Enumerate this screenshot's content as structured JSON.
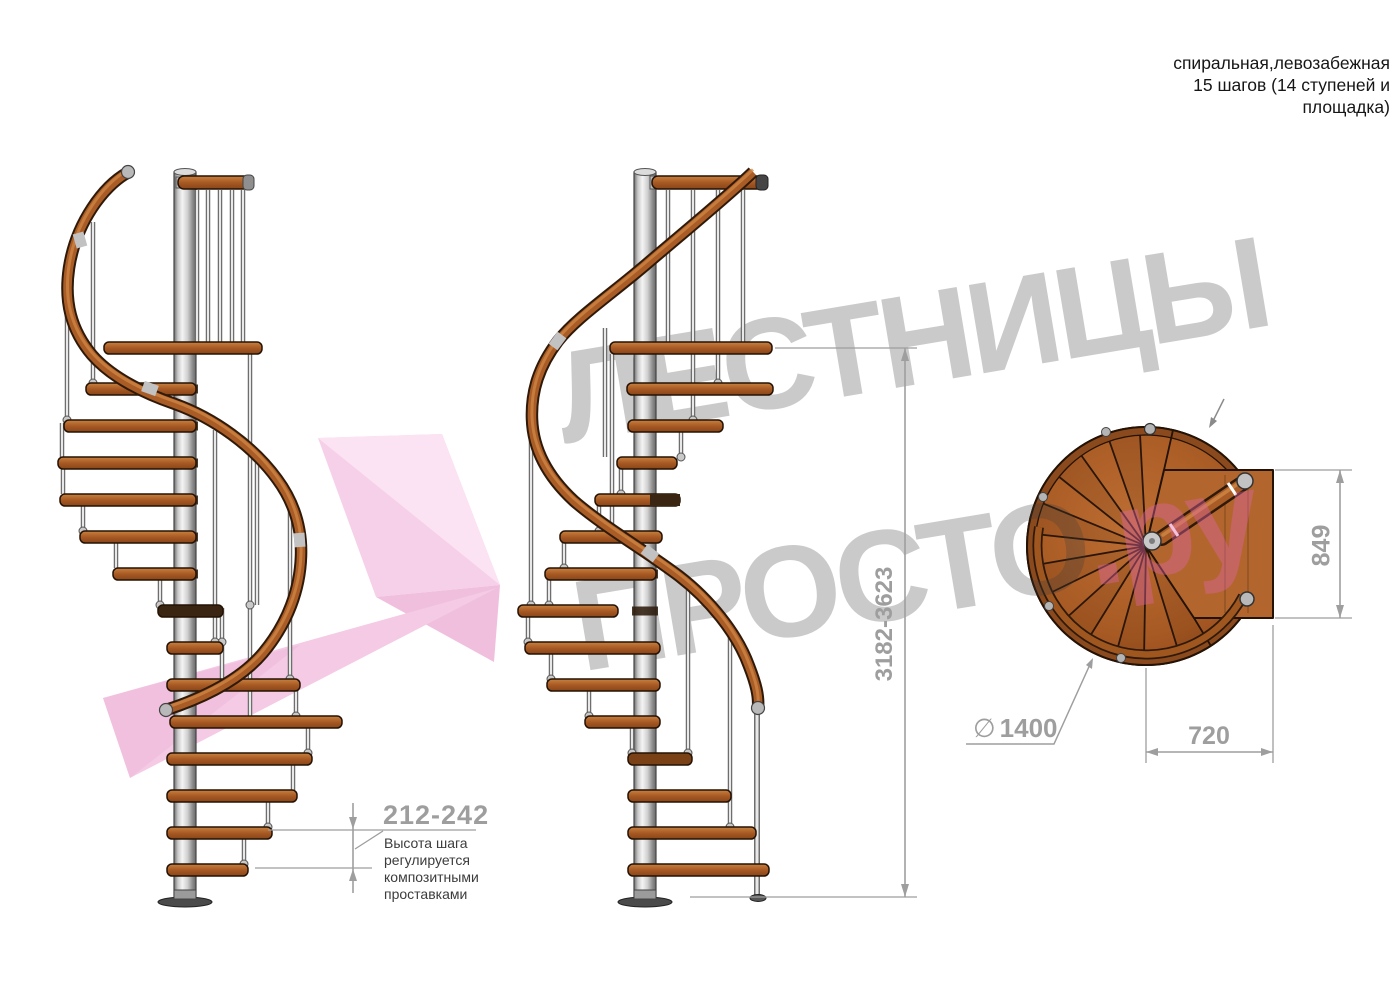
{
  "title": {
    "line1": "спиральная,левозабежная",
    "line2": "15 шагов (14 ступеней и",
    "line3": "площадка)"
  },
  "watermark": {
    "line1": "ЛЕСТНИЦЫ",
    "line2": "ПРОСТО",
    "suffix": ".ру"
  },
  "dimensions": {
    "total_height": "3182-3623",
    "step_height": "212-242",
    "step_note_line1": "Высота шага",
    "step_note_line2": "регулируется",
    "step_note_line3": "композитными",
    "step_note_line4": "проставками",
    "landing_depth": "849",
    "landing_width": "720",
    "diameter_symbol": "∅",
    "diameter_value": "1400"
  },
  "colors": {
    "wood": "#a85a24",
    "wood_dark": "#3a2412",
    "handrail": "#aa5c26",
    "metal": "#c9c9c9",
    "dimension_gray": "#9e9e9e",
    "note_text": "#3c3c3c",
    "watermark_gray": "#c6c6c6",
    "watermark_pink": "#f2c3de",
    "logo_pink": "#f6d0e8"
  }
}
